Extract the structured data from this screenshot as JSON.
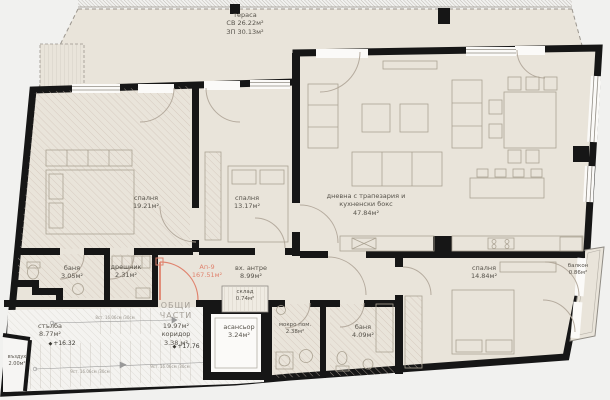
{
  "terrace": {
    "name": "тераса",
    "cb_area": "СВ 26.22м²",
    "zp_area": "ЗП 30.13м²"
  },
  "apartment": {
    "id": "Ап-9",
    "area": "167.51м²"
  },
  "rooms": {
    "bedroom1": {
      "name": "спалня",
      "area": "19.21м²"
    },
    "bedroom2": {
      "name": "спалня",
      "area": "13.17м²"
    },
    "living": {
      "name": "дневна с трапезария и",
      "name2": "кухненски бокс",
      "area": "47.84м²"
    },
    "bath1": {
      "name": "баня",
      "area": "3.05м²"
    },
    "closet": {
      "name": "дрешник",
      "area": "2.31м²"
    },
    "entry": {
      "name": "вх. антре",
      "area": "8.99м²"
    },
    "storage": {
      "name": "склад",
      "area": "0.74м²"
    },
    "elevator": {
      "name": "асансьор",
      "area": "3.24м²"
    },
    "wetroom": {
      "name": "мокро пом.",
      "area": "2.38м²"
    },
    "bath2": {
      "name": "баня",
      "area": "4.09м²"
    },
    "bedroom3": {
      "name": "спалня",
      "area": "14.84м²"
    },
    "balcony": {
      "name": "балкон",
      "area": "0.86м²"
    },
    "stairs": {
      "name": "стълба",
      "area": "8.77м²"
    },
    "air": {
      "name": "въздух",
      "area": "2.00м²"
    }
  },
  "common": {
    "title1": "ОБЩИ",
    "title2": "ЧАСТИ",
    "area": "19.97м²",
    "corridor_name": "коридор",
    "corridor_area": "3.38 м²"
  },
  "levels": {
    "corridor": "+17.76",
    "stairs": "+16.32"
  },
  "stair_dims": {
    "top": "8ст. 16.06см /30см",
    "bottom1": "9ст. 16.06см /30см",
    "bottom2": "9ст. 16.06см /30см"
  },
  "icons": {
    "level_marker": "◆"
  },
  "colors": {
    "floor": "#e9e4da",
    "wall": "#161616",
    "accent": "#e0836e",
    "background": "#f1f1ef"
  }
}
